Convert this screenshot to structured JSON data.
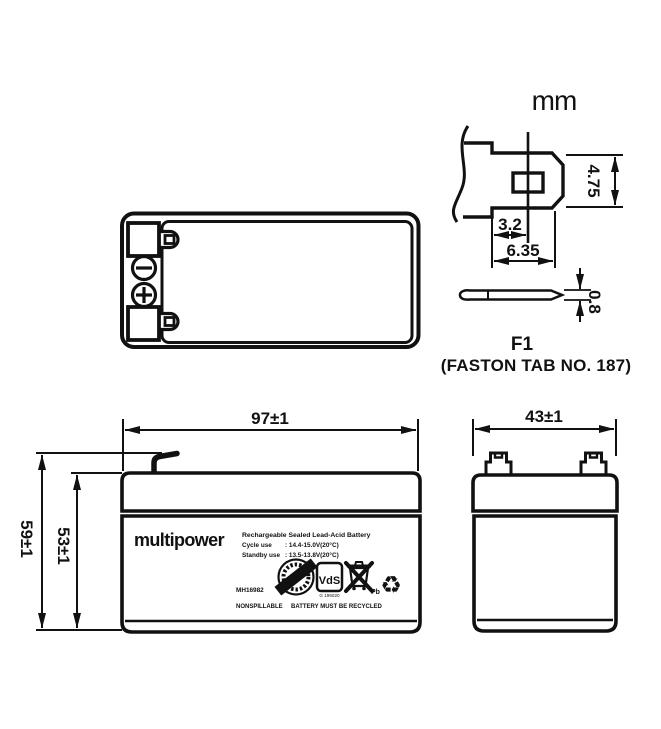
{
  "unit_label": "mm",
  "colors": {
    "ink": "#111111",
    "paper": "#ffffff"
  },
  "terminal_detail": {
    "title": "F1",
    "subtitle": "(FASTON TAB NO. 187)",
    "dims": {
      "height": "4.75",
      "hole_offset": "3.2",
      "width": "6.35",
      "thickness": "0.8"
    }
  },
  "front_view": {
    "dims": {
      "width": "97±1",
      "total_height": "59±1",
      "case_height": "53±1"
    },
    "label": {
      "brand": "multipower",
      "product": "Rechargeable Sealed Lead-Acid Battery",
      "cycle_use_label": "Cycle use",
      "cycle_use_value": ": 14.4-15.0V(20°C)",
      "standby_use_label": "Standby use",
      "standby_use_value": ": 13.5-13.8V(20°C)",
      "model": "MH16982",
      "cert_mark": "VdS",
      "cert_number": "G 196020",
      "pb_label": "Pb",
      "recycle_symbol": "♻",
      "note_left": "NONSPILLABLE",
      "note_right": "BATTERY MUST BE RECYCLED"
    }
  },
  "side_view": {
    "dims": {
      "width": "43±1"
    }
  }
}
